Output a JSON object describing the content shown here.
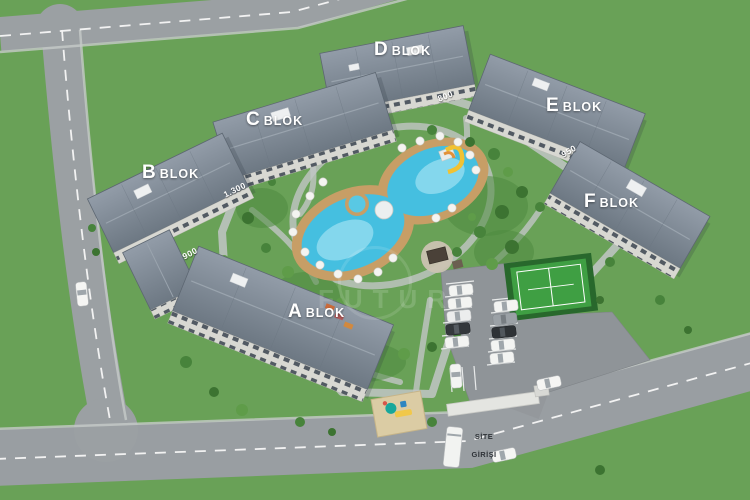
{
  "scene_title": "Aerial 3D site plan of residential complex",
  "blocks": [
    {
      "id": "a",
      "letter": "A",
      "word": "BLOK"
    },
    {
      "id": "b",
      "letter": "B",
      "word": "BLOK"
    },
    {
      "id": "c",
      "letter": "C",
      "word": "BLOK"
    },
    {
      "id": "d",
      "letter": "D",
      "word": "BLOK"
    },
    {
      "id": "e",
      "letter": "E",
      "word": "BLOK"
    },
    {
      "id": "f",
      "letter": "F",
      "word": "BLOK"
    }
  ],
  "distances": [
    {
      "value": "1.300"
    },
    {
      "value": "900"
    },
    {
      "value": "800"
    },
    {
      "value": "950"
    }
  ],
  "entrance": {
    "line1": "SİTE",
    "line2": "GİRİŞİ"
  },
  "watermark": {
    "text": "FUTUR"
  },
  "colors": {
    "grass": "#69a157",
    "road": "#9ba0a3",
    "roof": "#7b8692",
    "facade": "#d8d8d2",
    "pool_water": "#45bfe0",
    "pool_deck": "#c79e66",
    "tennis_court": "#3f9f43",
    "playground_sand": "#dbcca4",
    "label_text": "#ffffff"
  }
}
